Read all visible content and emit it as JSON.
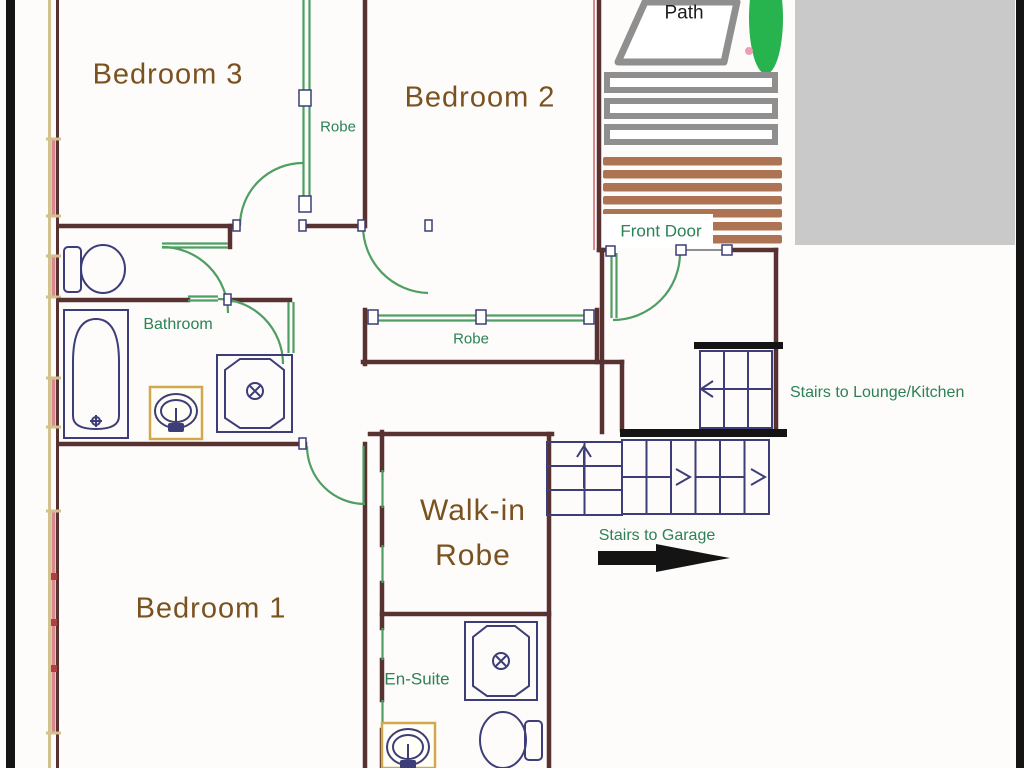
{
  "palette": {
    "wall": "#583131",
    "wall-tan": "#d3c190",
    "window-pink": "#d9898e",
    "window-red": "#b04040",
    "partition-green": "#4f9e63",
    "fixture-navy": "#3d3d78",
    "label-brown": "#7a5220",
    "label-green": "#2c8156",
    "label-black": "#1c1c1c",
    "porch-brown": "#ad7352",
    "step-gray": "#8f8f8f",
    "block-gray": "#c9c9c9",
    "bush-green": "#27b34e",
    "dot-pink": "#eba0b6",
    "bar-black": "#141414",
    "sink-box-tan": "#d2a84e"
  },
  "labels": {
    "bedroom3": "Bedroom 3",
    "bedroom2": "Bedroom 2",
    "bedroom1": "Bedroom 1",
    "robe_top": "Robe",
    "robe_middle": "Robe",
    "walk_in_robe_line1": "Walk-in",
    "walk_in_robe_line2": "Robe",
    "bathroom": "Bathroom",
    "ensuite": "En-Suite",
    "front_door": "Front Door",
    "path": "Path",
    "stairs_lounge": "Stairs to Lounge/Kitchen",
    "stairs_garage": "Stairs to Garage"
  }
}
